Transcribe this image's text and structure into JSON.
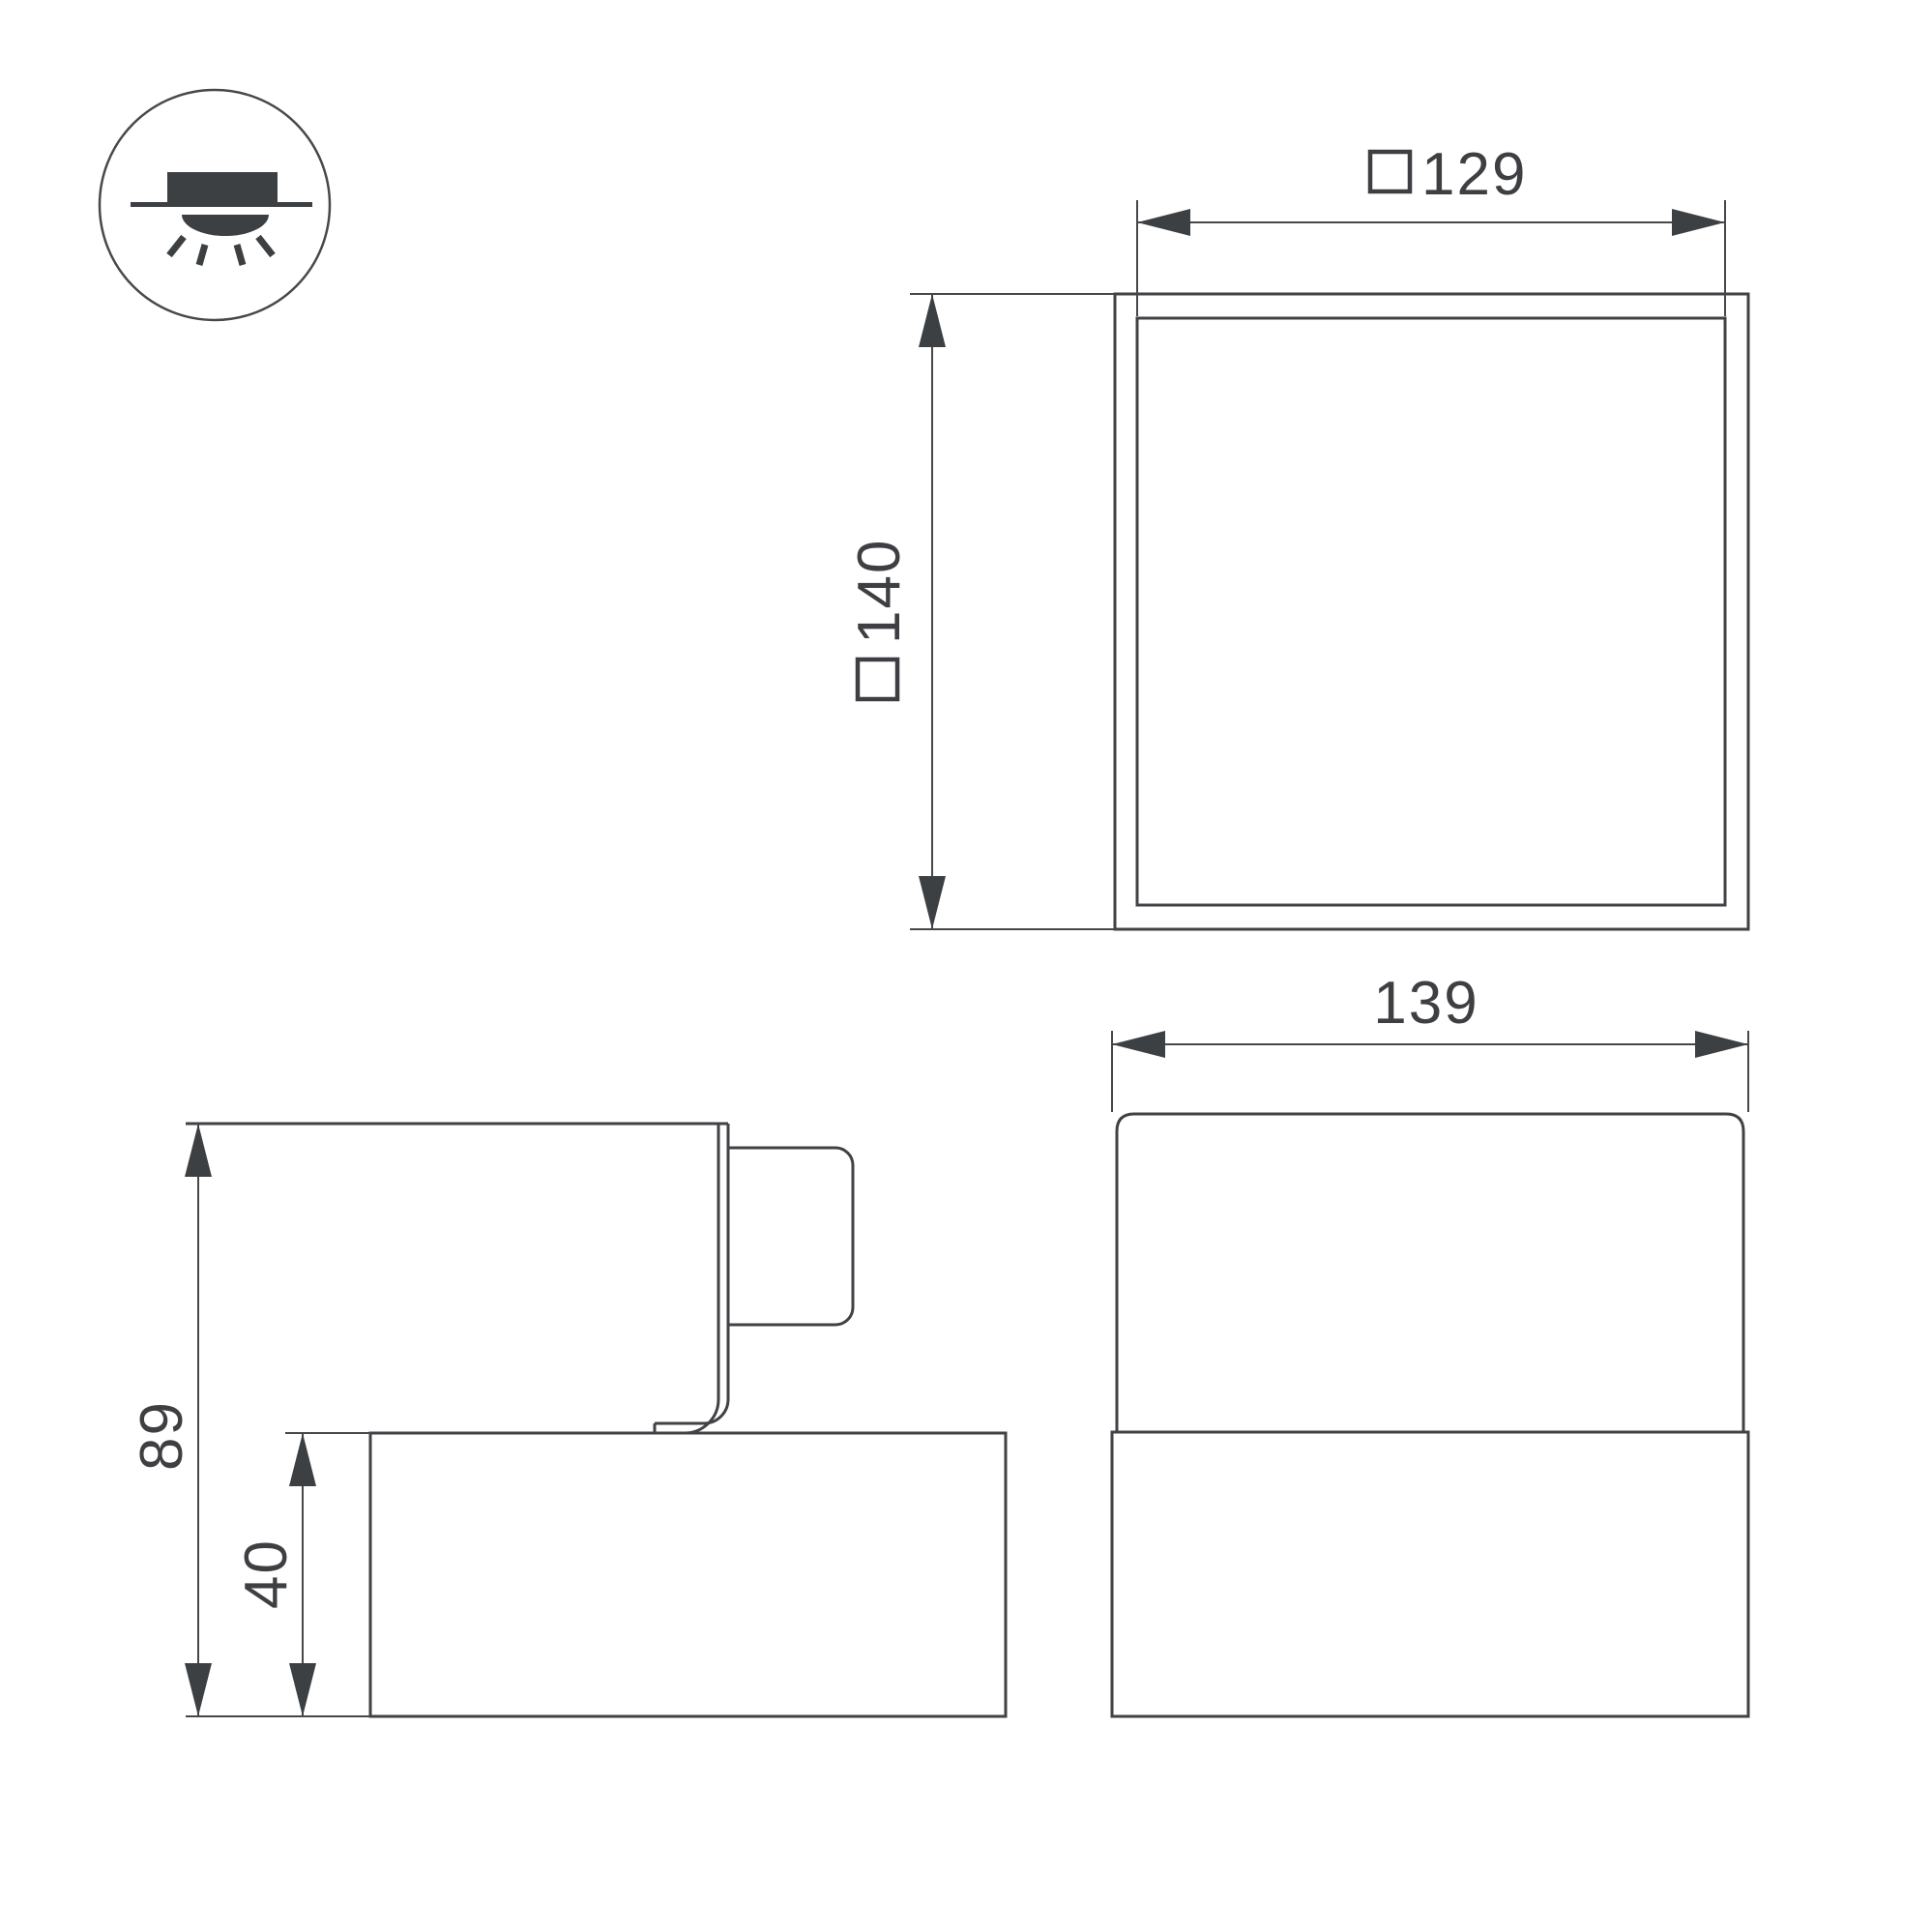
{
  "drawing": {
    "type": "luminaire-dimension-drawing",
    "background": "#ffffff",
    "line_color": "#404245",
    "text_color": "#3d3f42"
  },
  "icon_legend": {
    "name": "surface-mounted-light-symbol",
    "description": "circle badge showing surface-mounted fixture on ceiling with downward light rays"
  },
  "dimensions": {
    "top_view": {
      "inner_width": {
        "symbol": "□",
        "value": "129"
      },
      "outer_size": {
        "symbol": "□",
        "value": "140"
      }
    },
    "side_view": {
      "total_height": {
        "value": "89"
      },
      "base_height": {
        "value": "40"
      }
    },
    "front_view": {
      "width": {
        "value": "139"
      }
    }
  }
}
